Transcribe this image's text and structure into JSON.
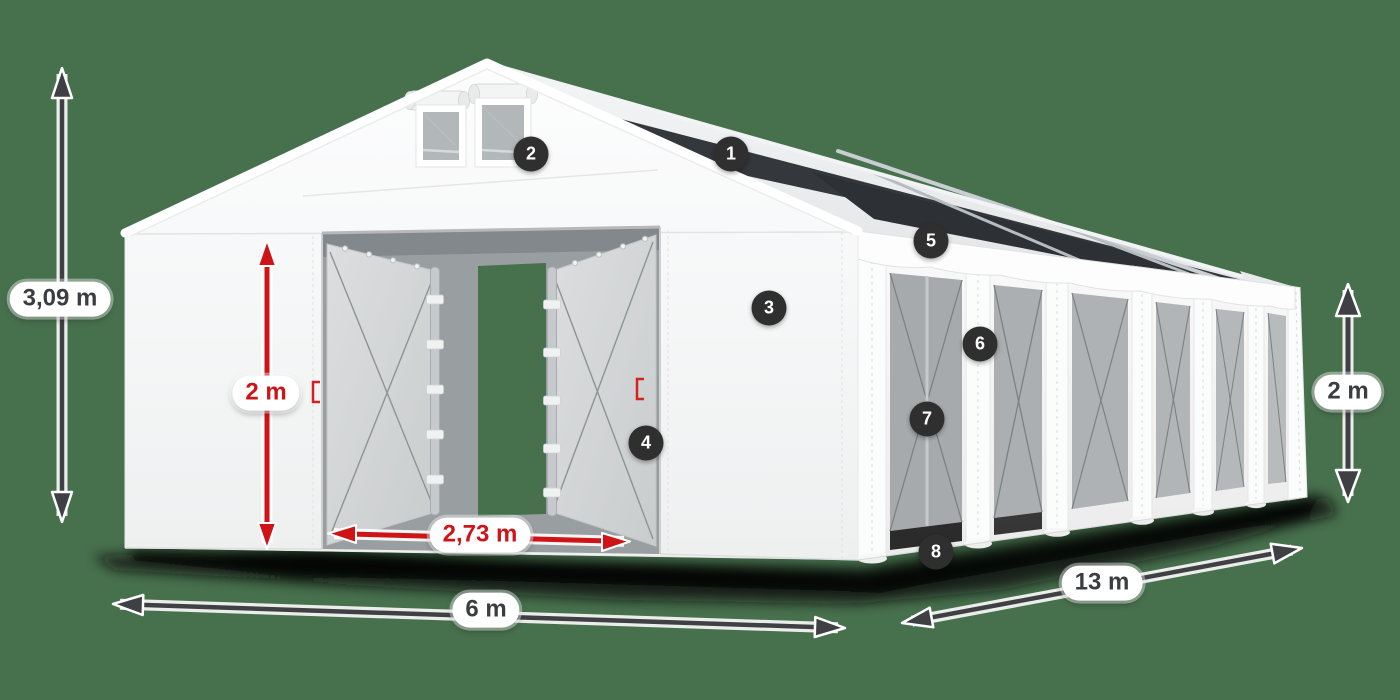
{
  "scene": {
    "background_color": "#47704d",
    "dimension_dark_color": "#3f4043",
    "dimension_red_color": "#ce1417",
    "badge_color": "#2f2f30",
    "tent_color": "#f7f7f8"
  },
  "labels": {
    "total_height": "3,09 m",
    "door_height": "2 m",
    "door_width": "2,73 m",
    "front_width": "6 m",
    "side_length": "13 m",
    "side_height": "2 m"
  },
  "callouts": [
    {
      "number": "1"
    },
    {
      "number": "2"
    },
    {
      "number": "3"
    },
    {
      "number": "4"
    },
    {
      "number": "5"
    },
    {
      "number": "6"
    },
    {
      "number": "7"
    },
    {
      "number": "8"
    }
  ]
}
